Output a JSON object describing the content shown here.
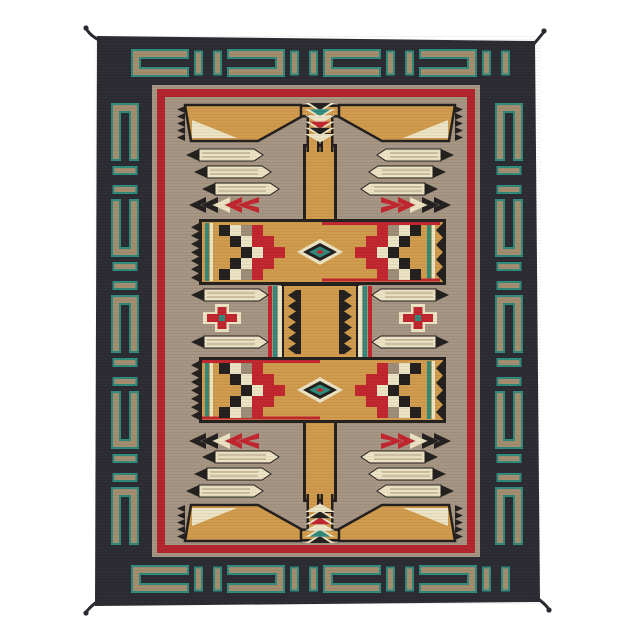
{
  "meta": {
    "title": "Handwoven Navajo-Style Storm Pattern Rug",
    "description": "Product photograph of a handwoven Navajo-style storm pattern wool rug on a plain white background. Dark charcoal outer border with a teal-outlined tan chain-link meander, red inner border stripe, taupe field with camel storm-pattern column, stepped lightning lines, corner pennants, cream feathers with black tips, chevron arrows, checkerboard panels in black, cream, red and gray, diamond eye medallions, and red stepped crosses. Small dark tassels at all four corners.",
    "background": "#ffffff"
  },
  "palette": {
    "border_black": "#2a2a31",
    "border_tan": "#a28d6e",
    "teal": "#2f8a7b",
    "red": "#b2242c",
    "red2": "#c2252e",
    "field": "#a59482",
    "camel": "#d09a4b",
    "cream": "#ece3c3",
    "black": "#221f1d",
    "gray": "#9d8c77",
    "ridge": "#b9aa8e",
    "white": "#ffffff"
  },
  "rug": {
    "outline": [
      [
        97,
        36
      ],
      [
        535,
        41
      ],
      [
        540,
        602
      ],
      [
        95,
        606
      ]
    ],
    "border_links": {
      "top_count": 4,
      "side_count": 5,
      "connector_count": 4
    },
    "checker_left": [
      "KCGR..",
      ".KCRR.",
      "..KCRR",
      ".KCRR.",
      "KCGR.."
    ],
    "checker_right": [
      "..RGCK",
      ".RRCK.",
      "RRCK..",
      ".RRCK.",
      "..RGCK"
    ],
    "fletching_colors": [
      "black",
      "teal",
      "cream",
      "red2",
      "black",
      "cream"
    ],
    "arrow_colors": [
      "black",
      "black",
      "cream",
      "red2",
      "red2"
    ],
    "eye_layers": [
      "cream",
      "black",
      "teal",
      "red2"
    ],
    "cross_colors": {
      "halo": "cream",
      "body": "red2",
      "center": "teal"
    },
    "tassel_count": 4
  }
}
